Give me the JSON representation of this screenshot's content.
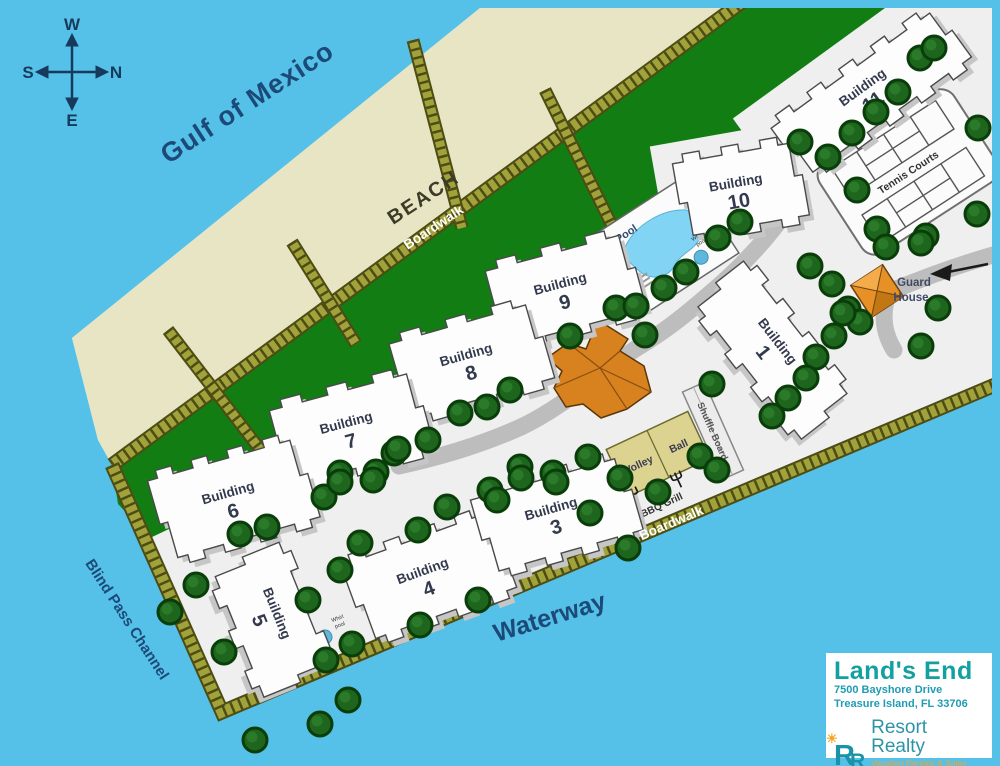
{
  "map": {
    "water_label": "Gulf of Mexico",
    "beach_label": "BEACH",
    "boardwalk_top_label": "Boardwalk",
    "boardwalk_bottom_label": "Boardwalk",
    "waterway_label": "Waterway",
    "channel_label": "Blind Pass Channel",
    "compass": {
      "n": "N",
      "s": "S",
      "e": "E",
      "w": "W"
    },
    "colors": {
      "water": "#55c1e8",
      "beach": "#e8e5c4",
      "dune_green": "#117d12",
      "boardwalk_olive": "#a2a23a",
      "road_gray": "#bdbdbd",
      "building_white": "#fdfdfd",
      "clubhouse_orange": "#d8821f",
      "pool_blue": "#82d4f4",
      "label_blue": "#1c4a78",
      "brand_teal": "#12a0a0",
      "brand_orange": "#f0a43a"
    }
  },
  "buildings": {
    "b1": {
      "label": "Building",
      "number": "1"
    },
    "b3": {
      "label": "Building",
      "number": "3"
    },
    "b4": {
      "label": "Building",
      "number": "4"
    },
    "b5": {
      "label": "Building",
      "number": "5"
    },
    "b6": {
      "label": "Building",
      "number": "6"
    },
    "b7": {
      "label": "Building",
      "number": "7"
    },
    "b8": {
      "label": "Building",
      "number": "8"
    },
    "b9": {
      "label": "Building",
      "number": "9"
    },
    "b10": {
      "label": "Building",
      "number": "10"
    },
    "b11": {
      "label": "Building",
      "number": "11"
    }
  },
  "amenities": {
    "tennis": "Tennis Courts",
    "guard_line1": "Guard",
    "guard_line2": "House",
    "pool": "Pool",
    "whirlpool_line1": "Whirl",
    "whirlpool_line2": "pool",
    "shuffleboard": "Shuffle Board",
    "volleyball_word1": "Volley",
    "volleyball_word2": "Ball",
    "bbq": "BBQ Grill"
  },
  "info_box": {
    "name": "Land's End",
    "address_line1": "7500 Bayshore Drive",
    "address_line2": "Treasure Island, FL 33706",
    "monogram_r1": "R",
    "monogram_r2": "R",
    "brand": "Resort Realty",
    "tagline": "Vacation Rentals & Sales"
  }
}
